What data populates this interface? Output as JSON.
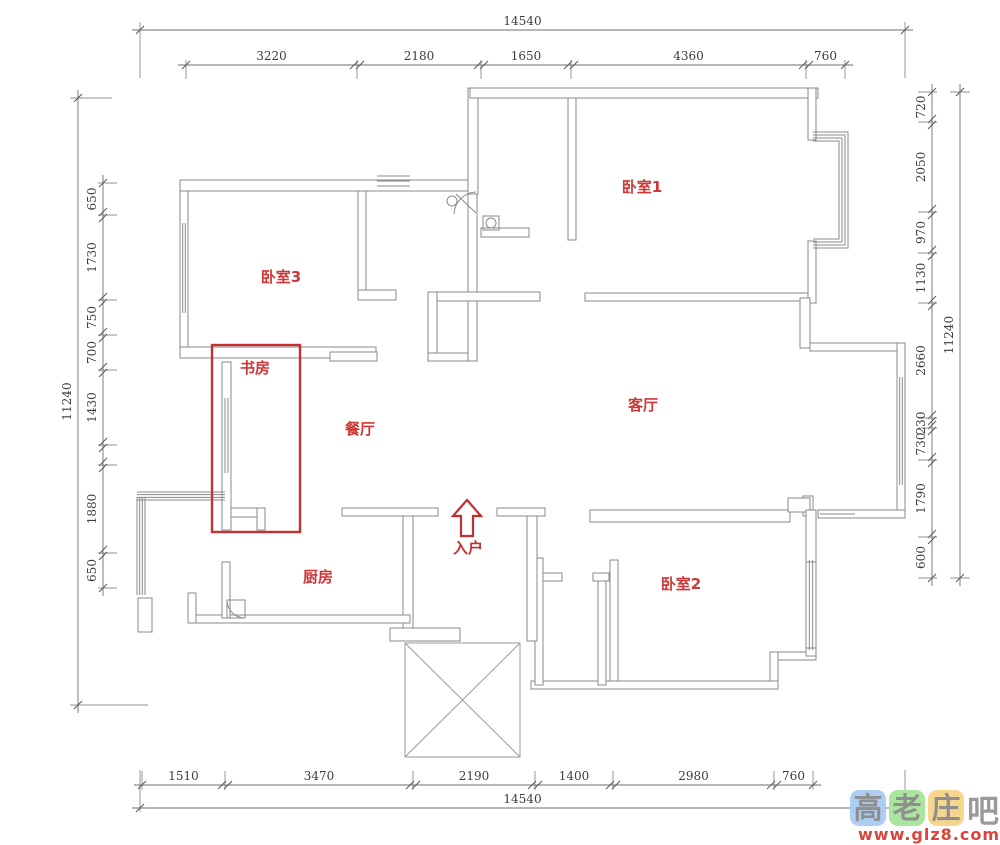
{
  "colors": {
    "wall": "#8a8a8a",
    "wall_fill": "#ffffff",
    "dim_line": "#6e6e6e",
    "dim_text": "#3d3d3d",
    "room_label": "#ce3737",
    "red_box": "#c53030",
    "arrow_red": "#c22f2f",
    "porch": "#9a9a9a",
    "wm_blue": "#aecdf2",
    "wm_green": "#abe49f",
    "wm_yellow": "#f6d68c",
    "wm_gray": "#8f8f8f",
    "wm_url_red": "#d9453c"
  },
  "rooms": [
    {
      "name": "卧室1",
      "x": 642,
      "y": 192
    },
    {
      "name": "卧室3",
      "x": 281,
      "y": 282
    },
    {
      "name": "书房",
      "x": 255,
      "y": 373
    },
    {
      "name": "餐厅",
      "x": 360,
      "y": 434
    },
    {
      "name": "客厅",
      "x": 643,
      "y": 410
    },
    {
      "name": "厨房",
      "x": 318,
      "y": 582
    },
    {
      "name": "卧室2",
      "x": 681,
      "y": 589
    }
  ],
  "entrance": {
    "label": "入户",
    "label_x": 468,
    "label_y": 553,
    "arrow_points": "467,500 481,516 473,516 473,536 461,536 461,516 453,516"
  },
  "dimensions": {
    "chains": [
      {
        "orient": "h",
        "pos": 30,
        "dir": 1,
        "ext": false,
        "ticks": [
          140,
          905
        ],
        "labels": [
          "14540"
        ]
      },
      {
        "orient": "h",
        "pos": 65,
        "dir": 1,
        "ext": true,
        "ticks": [
          186,
          357,
          481,
          571,
          806,
          845
        ],
        "labels": [
          "3220",
          "2180",
          "1650",
          "4360",
          "760"
        ]
      },
      {
        "orient": "h",
        "pos": 785,
        "dir": -1,
        "ext": true,
        "ticks": [
          142,
          225,
          413,
          535,
          613,
          774,
          813
        ],
        "labels": [
          "1510",
          "3470",
          "2190",
          "1400",
          "2980",
          "760"
        ]
      },
      {
        "orient": "h",
        "pos": 808,
        "dir": -1,
        "ext": false,
        "ticks": [
          140,
          905
        ],
        "labels": [
          "14540"
        ]
      },
      {
        "orient": "v",
        "pos": 78,
        "dir": 1,
        "ext": false,
        "ticks": [
          98,
          705
        ],
        "labels": [
          "11240"
        ]
      },
      {
        "orient": "v",
        "pos": 103,
        "dir": 1,
        "ext": true,
        "ticks": [
          183,
          215,
          300,
          335,
          370,
          445,
          465,
          553,
          588
        ],
        "labels": [
          "650",
          "1730",
          "750",
          "700",
          "1430",
          "",
          "1880",
          "650"
        ]
      },
      {
        "orient": "v",
        "pos": 932,
        "dir": -1,
        "ext": true,
        "ticks": [
          92,
          122,
          212,
          253,
          303,
          418,
          428,
          460,
          537,
          578
        ],
        "labels": [
          "720",
          "2050",
          "970",
          "1130",
          "2660",
          "230",
          "730",
          "1790",
          "600"
        ]
      },
      {
        "orient": "v",
        "pos": 960,
        "dir": -1,
        "ext": false,
        "ticks": [
          92,
          578
        ],
        "labels": [
          "11240"
        ]
      }
    ],
    "extra_lines": [
      [
        140,
        22,
        140,
        78
      ],
      [
        905,
        22,
        905,
        78
      ],
      [
        140,
        770,
        140,
        812
      ],
      [
        905,
        770,
        905,
        812
      ],
      [
        70,
        98,
        112,
        98
      ],
      [
        70,
        705,
        148,
        705
      ],
      [
        950,
        92,
        970,
        92
      ],
      [
        950,
        578,
        970,
        578
      ]
    ]
  },
  "plan": {
    "walls": [
      [
        180,
        180,
        295,
        11
      ],
      [
        468,
        88,
        10,
        106
      ],
      [
        470,
        88,
        348,
        10
      ],
      [
        180,
        191,
        8,
        166
      ],
      [
        180,
        347,
        196,
        11
      ],
      [
        358,
        191,
        8,
        101
      ],
      [
        358,
        290,
        38,
        10
      ],
      [
        428,
        292,
        9,
        69
      ],
      [
        330,
        352,
        47,
        9
      ],
      [
        428,
        353,
        49,
        8
      ],
      [
        468,
        194,
        9,
        167
      ],
      [
        437,
        292,
        103,
        9
      ],
      [
        568,
        98,
        8,
        142
      ],
      [
        585,
        293,
        223,
        8
      ],
      [
        808,
        88,
        8,
        52
      ],
      [
        808,
        241,
        8,
        62
      ],
      [
        800,
        298,
        10,
        50
      ],
      [
        810,
        343,
        95,
        8
      ],
      [
        897,
        343,
        8,
        175
      ],
      [
        818,
        510,
        87,
        8
      ],
      [
        803,
        496,
        10,
        20
      ],
      [
        590,
        510,
        200,
        12
      ],
      [
        788,
        498,
        22,
        14
      ],
      [
        806,
        510,
        10,
        52
      ],
      [
        770,
        652,
        46,
        8
      ],
      [
        770,
        652,
        8,
        34
      ],
      [
        806,
        648,
        10,
        8
      ],
      [
        531,
        681,
        247,
        8
      ],
      [
        610,
        560,
        8,
        121
      ],
      [
        598,
        575,
        8,
        110
      ],
      [
        593,
        573,
        16,
        8
      ],
      [
        535,
        573,
        27,
        8
      ],
      [
        535,
        558,
        8,
        127
      ],
      [
        527,
        516,
        10,
        125
      ],
      [
        497,
        508,
        48,
        8
      ],
      [
        342,
        508,
        96,
        8
      ],
      [
        403,
        516,
        10,
        116
      ],
      [
        390,
        628,
        70,
        13
      ],
      [
        190,
        615,
        220,
        8
      ],
      [
        188,
        593,
        8,
        30
      ],
      [
        222,
        562,
        8,
        56
      ],
      [
        138,
        598,
        14,
        34
      ],
      [
        222,
        362,
        9,
        168
      ],
      [
        231,
        508,
        34,
        9
      ],
      [
        257,
        508,
        8,
        22
      ],
      [
        481,
        228,
        48,
        9
      ]
    ],
    "windows": [
      {
        "o": "v",
        "x": 180,
        "w": 8,
        "a": 223,
        "b": 313,
        "n": 4
      },
      {
        "o": "h",
        "y": 176,
        "w": 15,
        "a": 377,
        "b": 410,
        "n": 4
      },
      {
        "o": "v",
        "x": 222,
        "w": 9,
        "a": 398,
        "b": 473,
        "n": 4
      },
      {
        "o": "h",
        "y": 492,
        "w": 8,
        "a": 137,
        "b": 225,
        "n": 4
      },
      {
        "o": "v",
        "x": 137,
        "w": 8,
        "a": 497,
        "b": 595,
        "n": 4
      },
      {
        "o": "v",
        "x": 897,
        "w": 8,
        "a": 377,
        "b": 485,
        "n": 4
      },
      {
        "o": "h",
        "y": 510,
        "w": 8,
        "a": 820,
        "b": 855,
        "n": 3
      },
      {
        "o": "v",
        "x": 806,
        "w": 10,
        "a": 560,
        "b": 650,
        "n": 4
      }
    ],
    "bays": [
      {
        "x1": 813,
        "y1": 132,
        "x2": 848,
        "y2": 248,
        "n": 4,
        "inset": 3
      }
    ],
    "fixtures": [
      [
        483,
        216,
        16,
        14
      ],
      [
        227,
        600,
        18,
        18
      ]
    ],
    "circles": [
      [
        452,
        201,
        5
      ],
      [
        491,
        223,
        5
      ]
    ],
    "arcs": [
      "M 227 600 A 18 18 0 0 0 245 618",
      "M 454 214 A 23 23 0 0 1 476 192",
      "M 476 213 L 456 194"
    ],
    "porch": {
      "x": 405,
      "y": 643,
      "w": 115,
      "h": 114
    },
    "red_box": {
      "x": 212,
      "y": 345,
      "w": 88,
      "h": 187
    }
  },
  "watermark": {
    "chars": [
      {
        "ch": "高",
        "bg": "wm_blue"
      },
      {
        "ch": "老",
        "bg": "wm_green"
      },
      {
        "ch": "庄",
        "bg": "wm_yellow"
      },
      {
        "ch": "吧",
        "bg": "none"
      }
    ],
    "url": "www.glz8.com"
  }
}
